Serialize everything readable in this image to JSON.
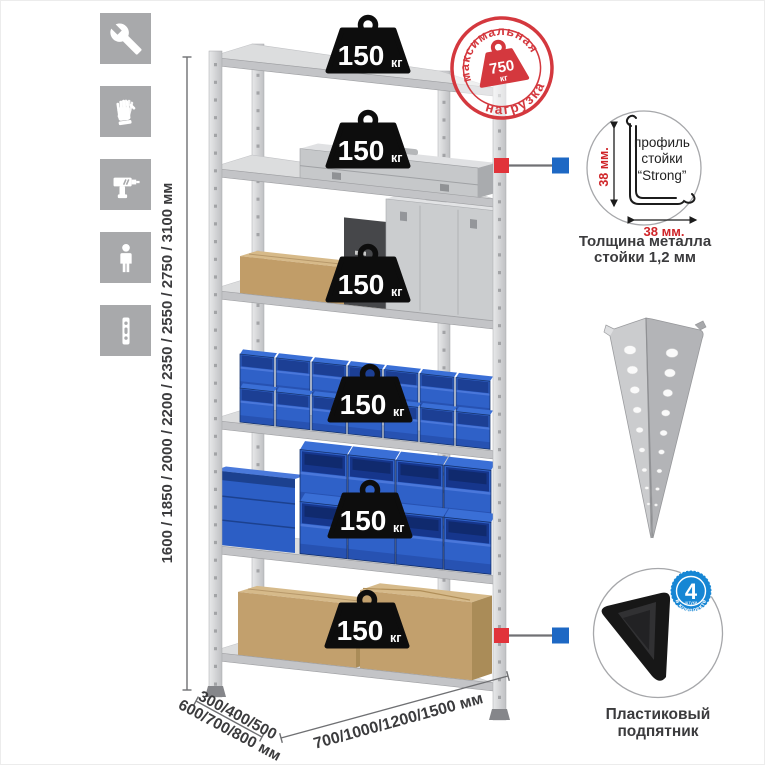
{
  "dimensions": {
    "height": "1600 / 1850 / 2000 / 2200 / 2350 / 2550 / 2750 / 3100 мм",
    "depth_line1": "300/400/500",
    "depth_line2": "600/700/800 мм",
    "width": "700/1000/1200/1500 мм"
  },
  "max_load_stamp": {
    "arc_top": "максимальная",
    "arc_bottom": "нагрузка",
    "value": "750",
    "unit": "кг"
  },
  "shelf_load": {
    "value": "150",
    "unit": "кг",
    "shelf_count": 6
  },
  "profile_callout": {
    "text_line1": "профиль",
    "text_line2": "стойки",
    "text_line3": "“Strong”",
    "dim_vertical": "38 мм.",
    "dim_horizontal": "38 мм.",
    "caption_line1": "Толщина металла",
    "caption_line2": "стойки 1,2 мм"
  },
  "foot_callout": {
    "badge_number": "4",
    "badge_sub": "штуки",
    "badge_arc": "в комплекте",
    "caption_line1": "Пластиковый",
    "caption_line2": "подпятник"
  },
  "sidebar_icons": [
    {
      "name": "wrench"
    },
    {
      "name": "gloves"
    },
    {
      "name": "drill"
    },
    {
      "name": "person"
    },
    {
      "name": "rack-post"
    }
  ],
  "colors": {
    "stamp_red": "#d4383e",
    "marker_red": "#e1333a",
    "marker_blue": "#1e68c4",
    "bin_blue": "#2f61c8",
    "cardboard": "#c2a06d",
    "metal": "#d6d7d9",
    "tile_gray": "#a8a9ab",
    "badge_blue": "#1686d4",
    "dim_text": "#3b3b3d",
    "dim_red": "#cf2428"
  }
}
